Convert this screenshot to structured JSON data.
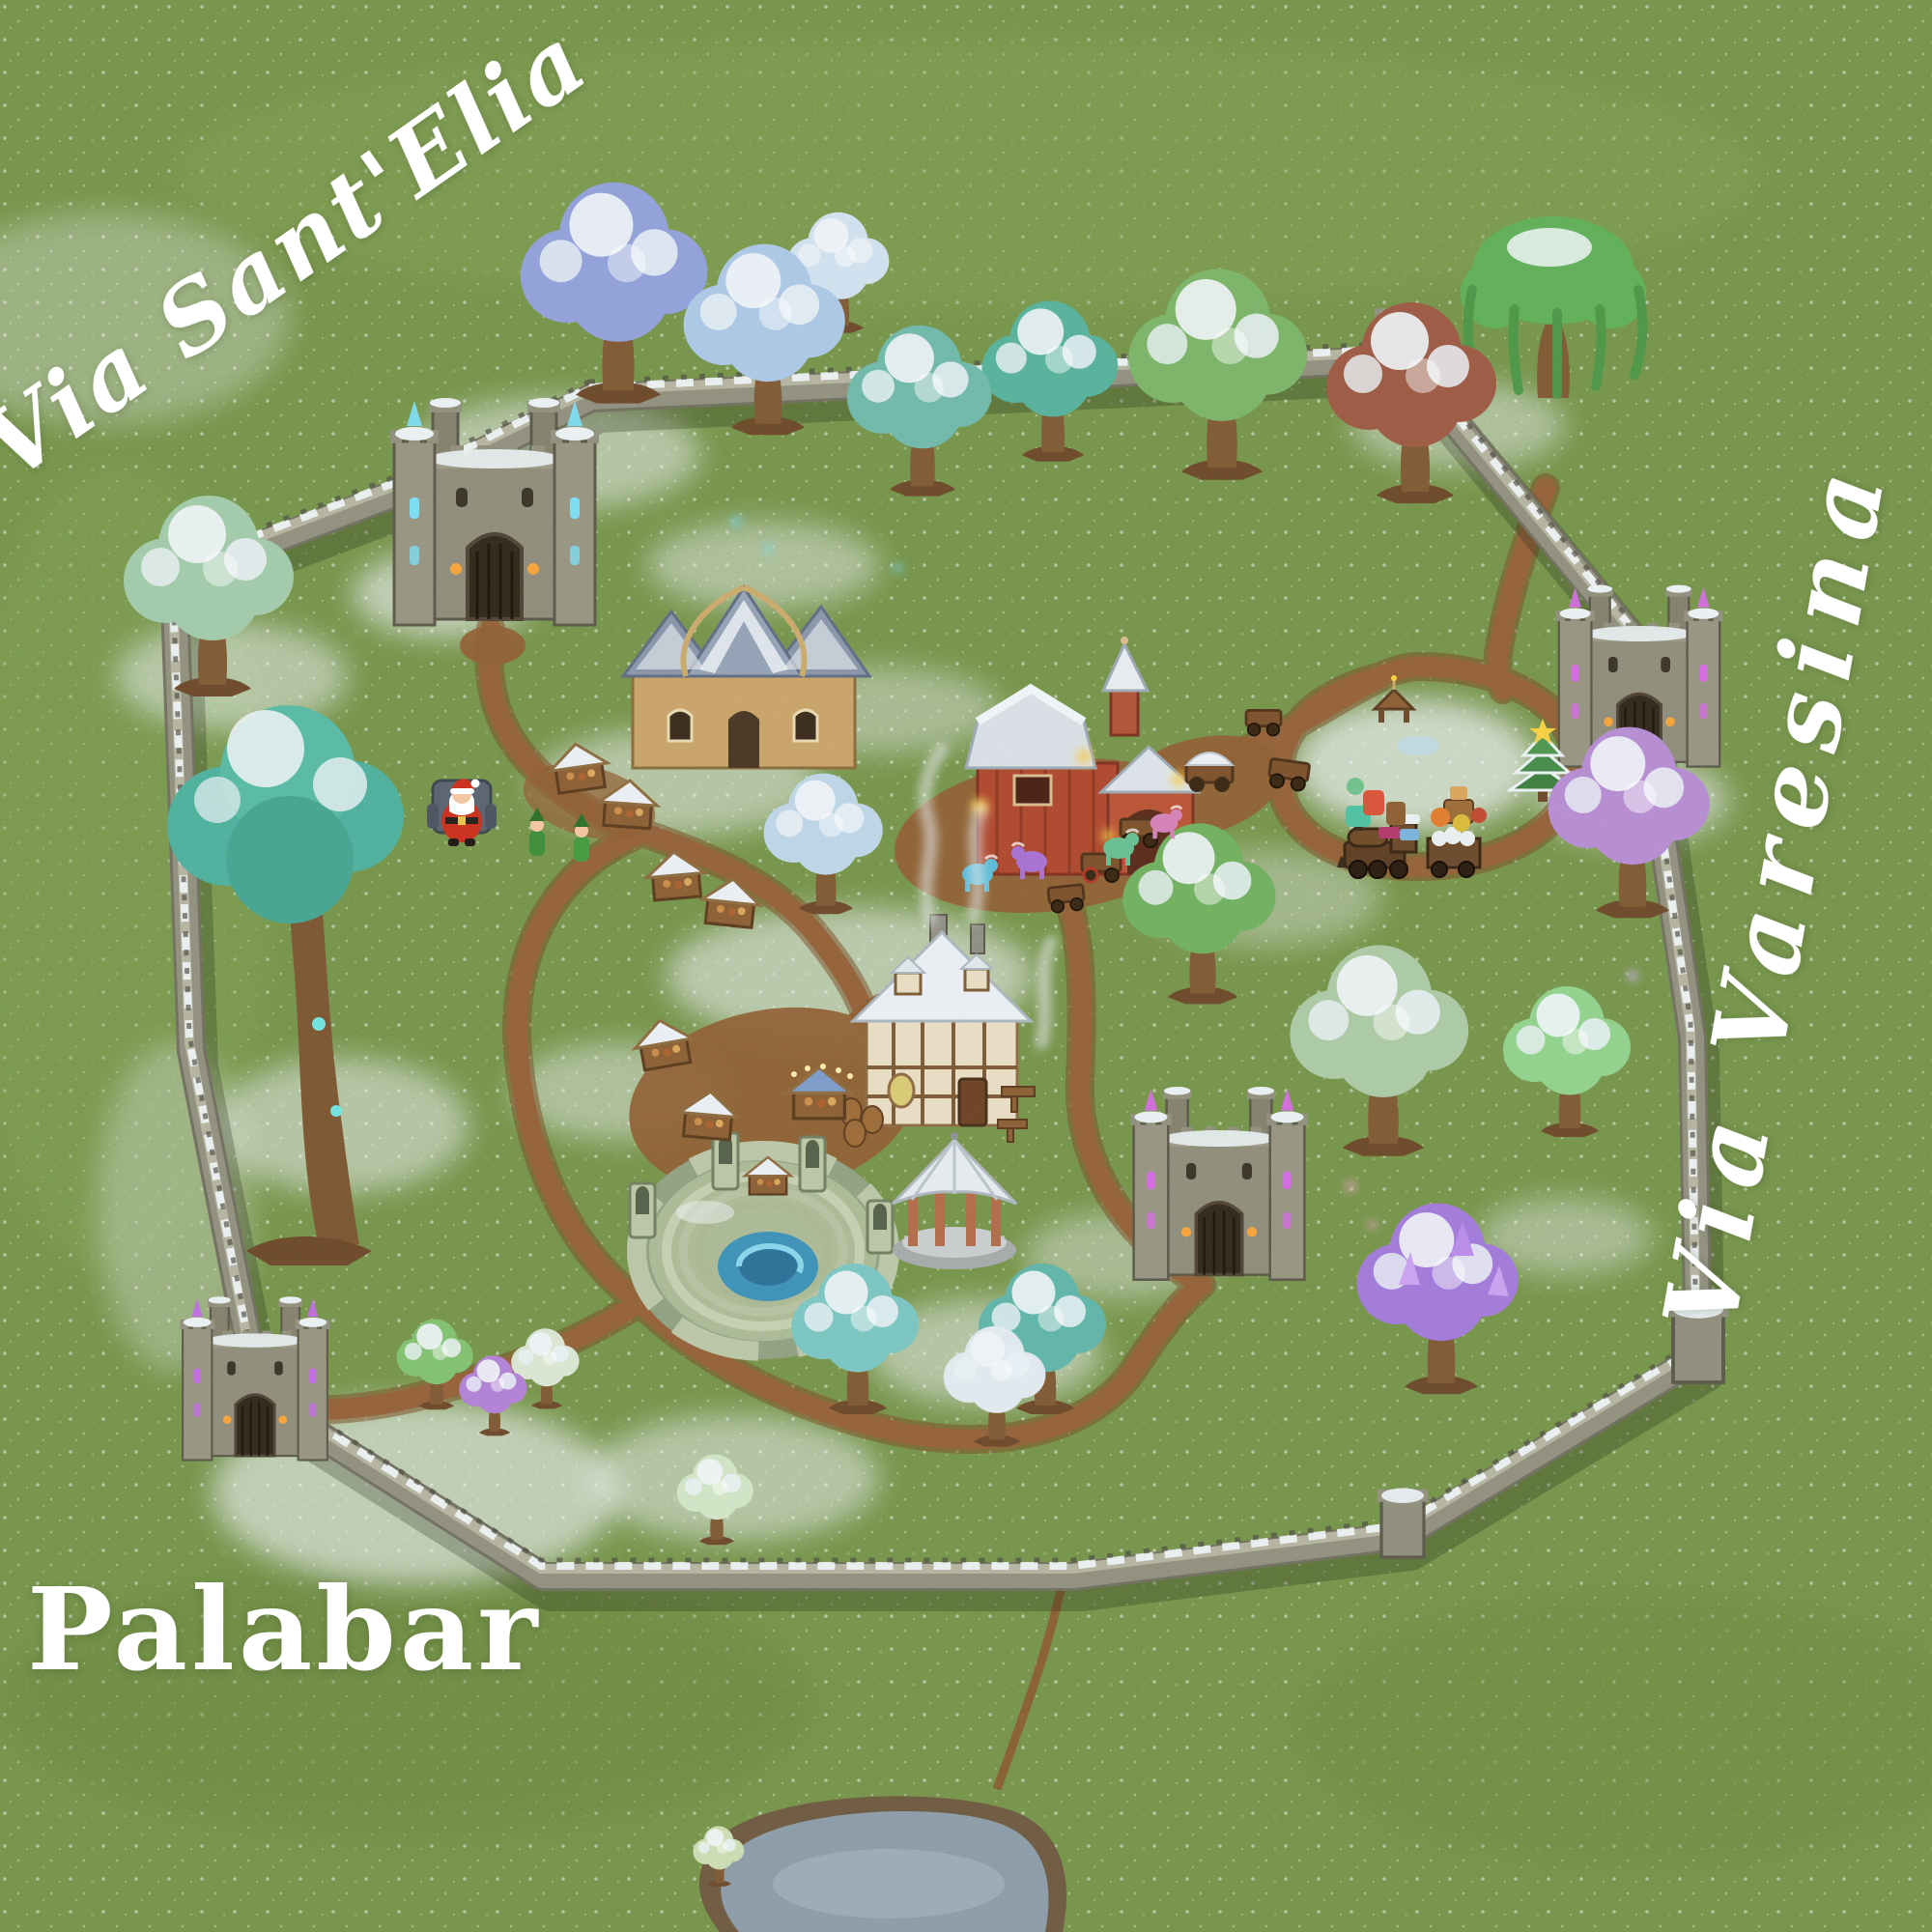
{
  "labels": {
    "top_left_street": "Via Sant'Elia",
    "right_street": "Via Varesina",
    "bottom_left_street": "Palabar"
  },
  "palette": {
    "grass": "#74924a",
    "grass_dark": "#5e7a39",
    "snow": "#e9eff3",
    "dirt_path": "#92613a",
    "wall_stone": "#8f8e7c",
    "wall_shadow": "#5a594a",
    "water": "#8a9aa6",
    "barn_red": "#ad4930",
    "tavern_cream": "#e7dcc2",
    "crystal_blue": "#7adcf2",
    "crystal_purple": "#d36ae0",
    "santa_red": "#c8321f",
    "elf_green": "#3f8a3a",
    "label_text": "#ffffff"
  },
  "scene": {
    "landmarks": [
      "nw-gatehouse",
      "east-gatehouse",
      "sw-gatehouse",
      "central-keep",
      "ne-corner-tower",
      "se-corner-tower",
      "south-wall-tower",
      "village-wall",
      "elf-hall",
      "red-barn",
      "tavern",
      "amphitheater",
      "gazebo",
      "pond",
      "santa-claus",
      "elf-figures",
      "ponies",
      "market-stalls",
      "carts",
      "toy-train",
      "christmas-tree",
      "nativity-scene",
      "fantasy-trees",
      "dirt-paths",
      "snow-patches"
    ]
  }
}
